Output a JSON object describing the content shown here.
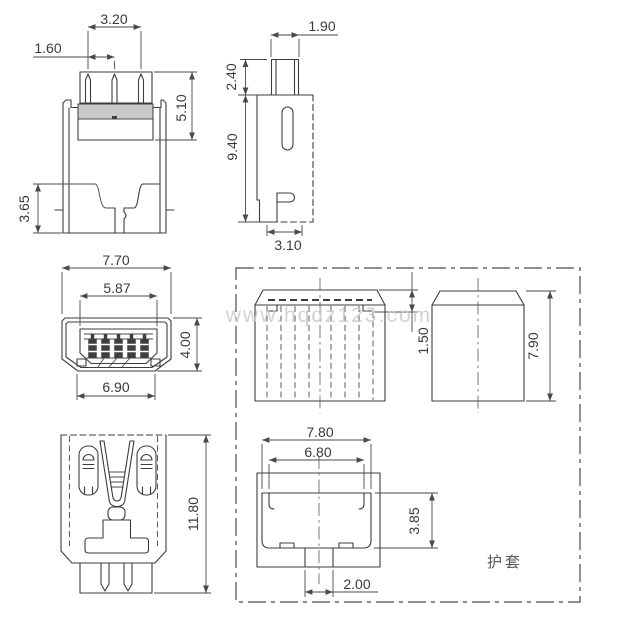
{
  "watermark": "www.hqdz123.com",
  "sheath_box_label": "护套",
  "views": {
    "plug_rear": {
      "dims": {
        "pin_row_width": "3.20",
        "pin_pitch": "1.60",
        "shell_depth": "5.10",
        "latch_offset": "3.65"
      }
    },
    "plug_side": {
      "dims": {
        "tab_width": "1.90",
        "tab_height": "2.40",
        "body_height": "9.40",
        "foot_width": "3.10"
      }
    },
    "plug_front": {
      "dims": {
        "outer_width": "7.70",
        "opening_width": "5.87",
        "height": "4.00",
        "bottom_width": "6.90"
      }
    },
    "plug_top": {
      "dims": {
        "total_length": "11.80"
      }
    },
    "sheath_top": {
      "dims": {
        "lip_depth": "1.50"
      }
    },
    "sheath_side": {
      "dims": {
        "width": "7.90"
      }
    },
    "sheath_front": {
      "dims": {
        "outer_width": "7.80",
        "inner_width": "6.80",
        "cavity_height": "3.85",
        "slot_width": "2.00"
      }
    }
  }
}
